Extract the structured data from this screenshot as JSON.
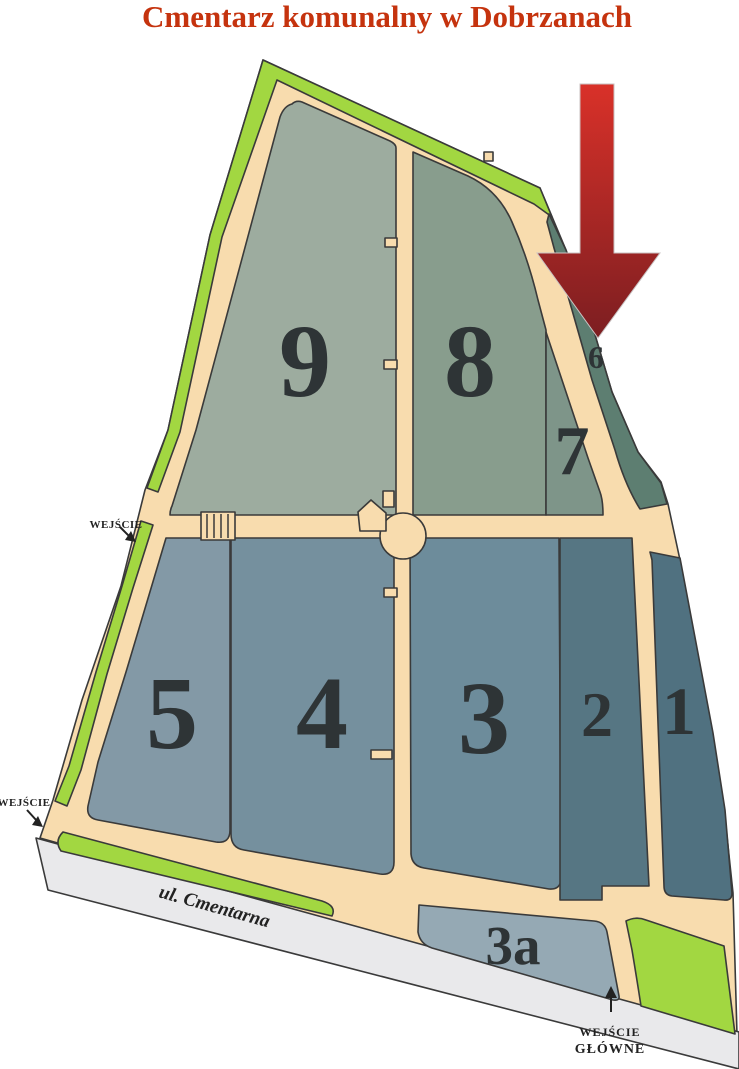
{
  "title": "Cmentarz komunalny w Dobrzanach",
  "map": {
    "sections": {
      "s1": {
        "label": "1"
      },
      "s2": {
        "label": "2"
      },
      "s3": {
        "label": "3"
      },
      "s3a": {
        "label": "3a"
      },
      "s4": {
        "label": "4"
      },
      "s5": {
        "label": "5"
      },
      "s6": {
        "label": "6"
      },
      "s7": {
        "label": "7"
      },
      "s8": {
        "label": "8"
      },
      "s9": {
        "label": "9"
      }
    },
    "street": {
      "name": "ul. Cmentarna"
    },
    "entrances": {
      "left": {
        "label": "WEJŚCIE"
      },
      "bottom_left": {
        "label": "WEJŚCIE"
      },
      "main": {
        "line1": "WEJŚCIE",
        "line2": "GŁÓWNE"
      }
    }
  },
  "colors": {
    "title": "#c5330e",
    "outline": "#3a3a3a",
    "path_base": "#f8dcae",
    "green": "#a2d741",
    "street": "#e9e9eb",
    "section_9": "#9dac9f",
    "section_8": "#889d8d",
    "section_7": "#7e9589",
    "section_6": "#5d7e71",
    "section_5": "#8399a6",
    "section_4": "#75909e",
    "section_3": "#6d8c9b",
    "section_2": "#567683",
    "section_1": "#507180",
    "section_3a": "#95a9b4",
    "number": "#2e3436",
    "label": "#222222",
    "arrow_top": "#d93129",
    "arrow_bottom": "#7c1e21"
  }
}
